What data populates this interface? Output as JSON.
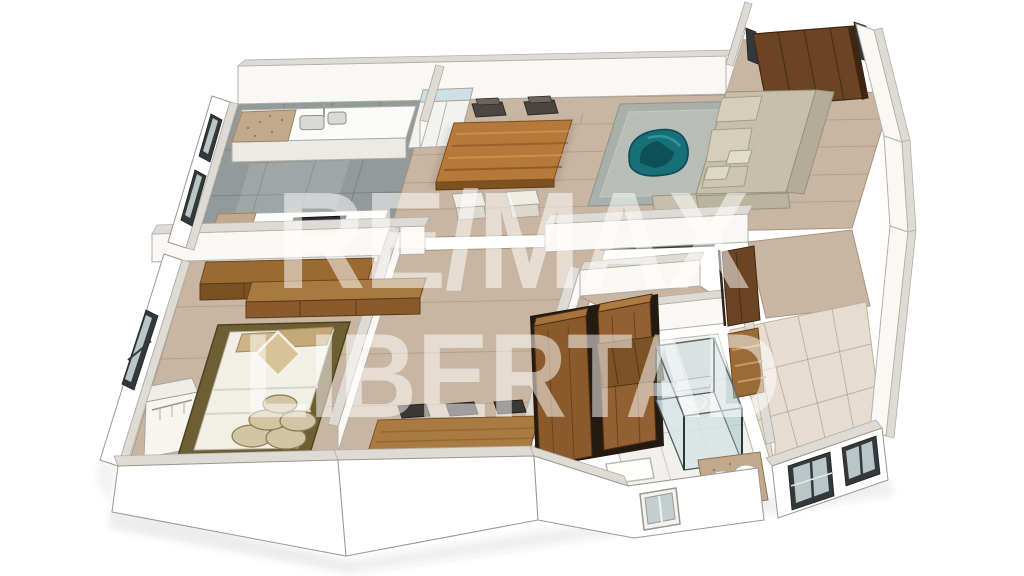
{
  "watermark": {
    "line1": "RE/MAX",
    "line2": "LIBERTAD",
    "color": "#ffffff",
    "opacity": 0.52
  },
  "scene": {
    "type": "3d-floor-plan-render",
    "style": "isometric dollhouse cutaway of a two-bedroom apartment",
    "background_color": "#ffffff",
    "rooms": [
      {
        "name": "kitchen",
        "floor": "gray concrete tile",
        "contents": [
          "counter with double sink",
          "granite countertop corner",
          "refrigerator",
          "front counter with cooktop",
          "dark framed windows"
        ]
      },
      {
        "name": "dining-area",
        "floor": "light wood",
        "contents": [
          "wooden dining table",
          "two dark chairs",
          "two upholstered white chairs"
        ]
      },
      {
        "name": "living-room",
        "floor": "light wood",
        "contents": [
          "gray area rug",
          "beige L-shaped sofa with cushions",
          "teal accent chair",
          "dark media console"
        ]
      },
      {
        "name": "entry",
        "floor": "light wood",
        "contents": [
          "open wooden entry door"
        ]
      },
      {
        "name": "master-bedroom",
        "floor": "light wood",
        "contents": [
          "double bed with white duvet",
          "tan headboard pillows",
          "diamond accent pillow",
          "stacked round cushions",
          "olive-brown area rug",
          "floating wood cabinets",
          "open white wardrobe",
          "dark framed window"
        ]
      },
      {
        "name": "second-bedroom",
        "floor": "light wood",
        "contents": [
          "long wooden desk counter",
          "three dark chairs",
          "double-door wood wardrobe"
        ]
      },
      {
        "name": "bathroom",
        "floor": "white tile",
        "contents": [
          "glass shower enclosure",
          "toilet",
          "granite vanity with white basins",
          "wood ladder shelf",
          "white bath mat",
          "white framed window",
          "open wood door"
        ]
      },
      {
        "name": "laundry-patio",
        "floor": "beige tile",
        "contents": [
          "two dark framed windows",
          "open wood door"
        ]
      }
    ]
  },
  "palette": {
    "wall_face": "#faf8f4",
    "wall_top": "#dedbd4",
    "wood_floor": "#c9b6a2",
    "gray_tile": "#939a99",
    "beige_tile": "#e6ddd0",
    "bath_tile": "#f1f0ec",
    "table_wood": "#b5793a",
    "entry_door_wood": "#6b4423",
    "wardrobe_wood": "#8a5a2c",
    "shelf_wood": "#9a6a38",
    "desk_wood": "#a97a42",
    "cabinet_wood": "#9a6a35",
    "sofa_beige": "#c6c0ab",
    "rug_gray": "#a9afaa",
    "accent_teal": "#177078",
    "granite": "#c3a98b",
    "bed_linen": "#f2efe7",
    "pillow_tan": "#cdb387",
    "bed_rug_olive": "#6e5e33",
    "window_frame": "#33383a",
    "media_console": "#50544f"
  }
}
